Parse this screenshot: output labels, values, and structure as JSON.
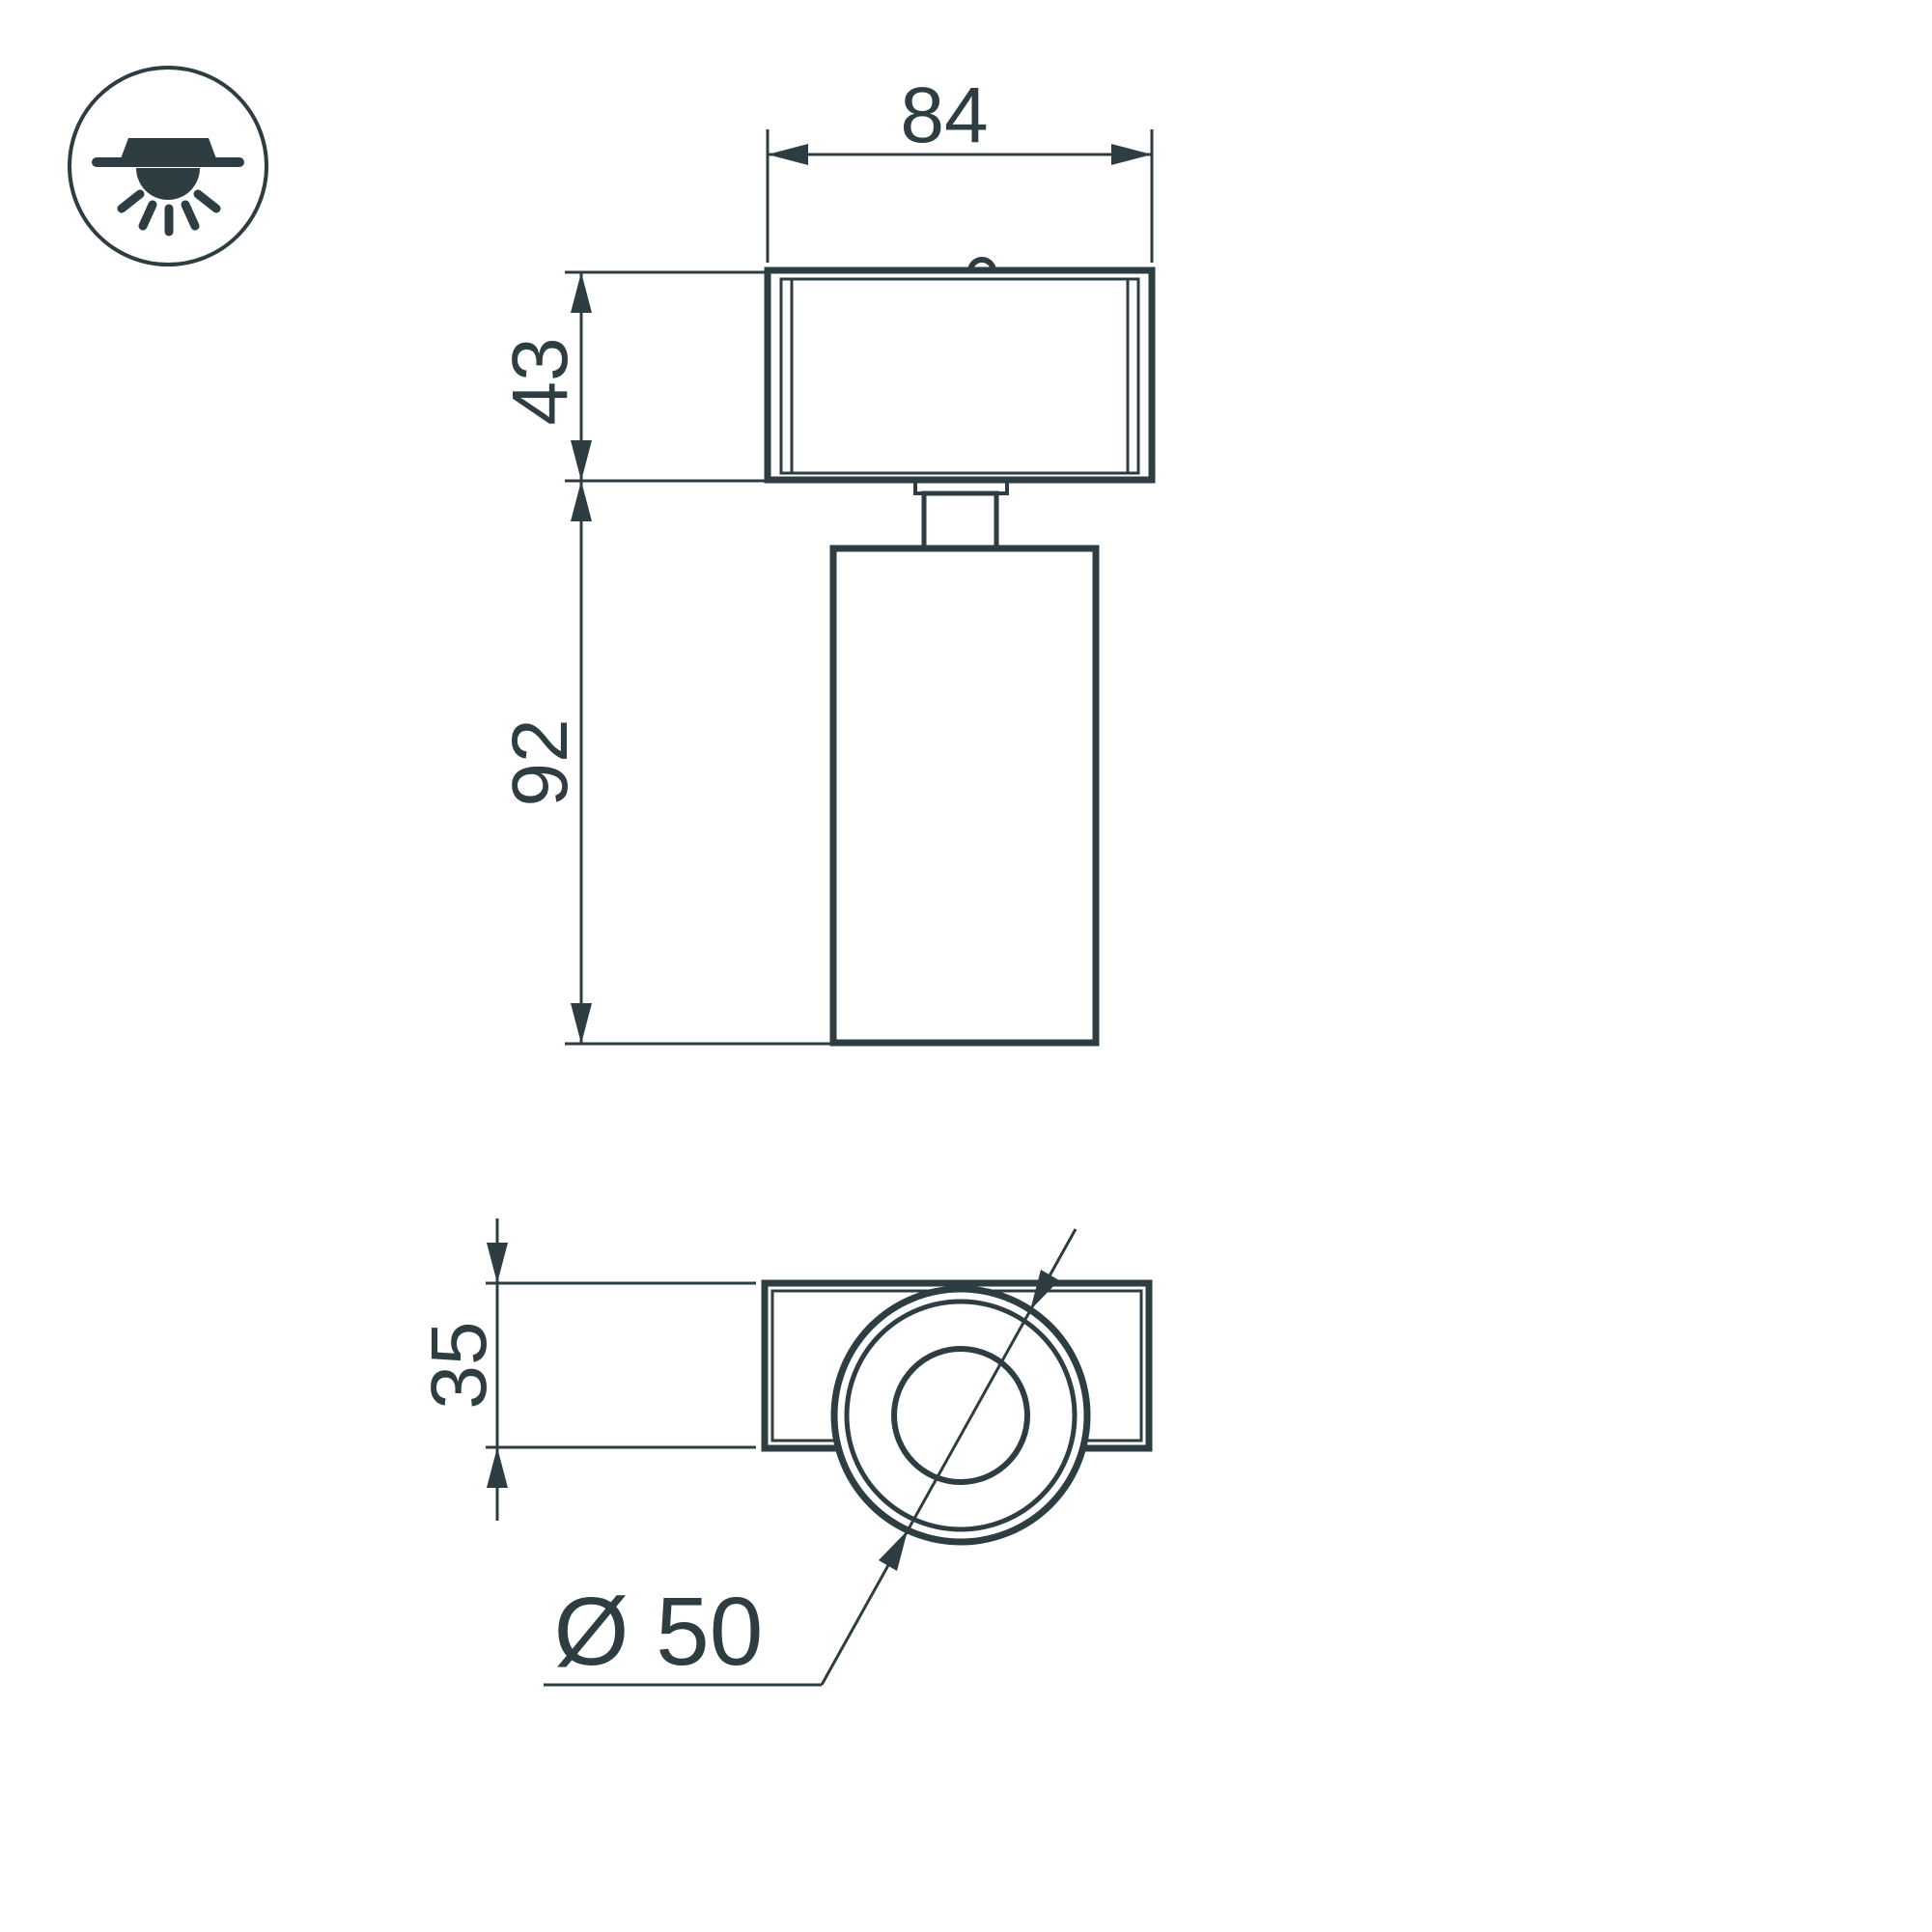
{
  "colors": {
    "ink": "#2e3d41",
    "background": "#ffffff"
  },
  "icon": {
    "type": "surface-mounted-ceiling-light"
  },
  "front_view": {
    "width_label": "84",
    "adapter_height_label": "43",
    "body_height_label": "92"
  },
  "bottom_view": {
    "depth_label": "35",
    "diameter_label": "Ø 50"
  }
}
